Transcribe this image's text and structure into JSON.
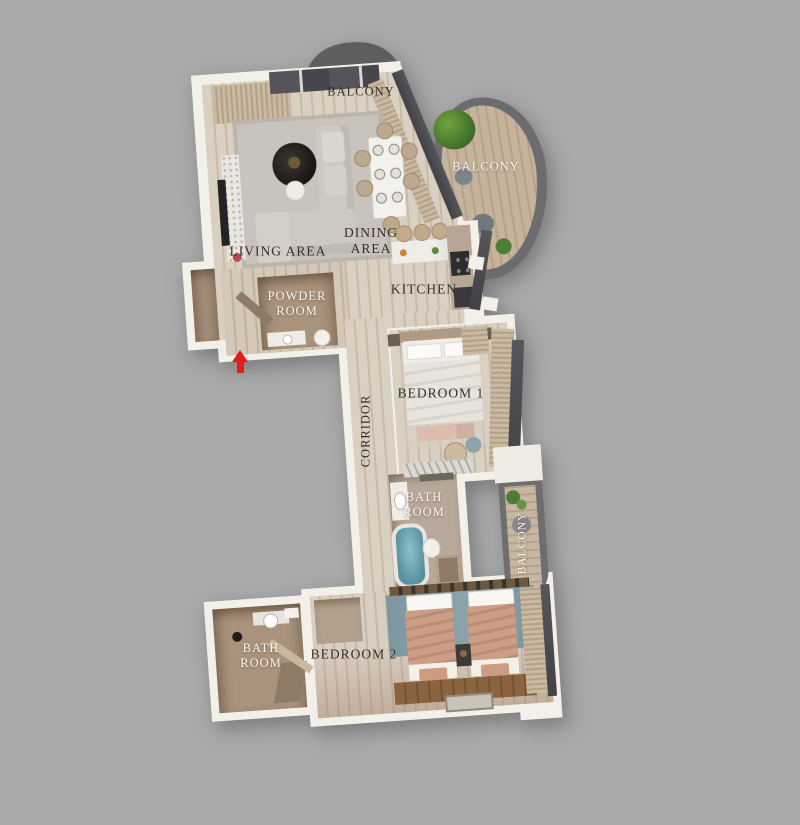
{
  "title": "3D apartment floor plan",
  "background_color": "#a9a9a9",
  "colors": {
    "wall": "#f3f0ea",
    "floor_wood": "#d5c9ba",
    "floor_taupe": "#a9937d",
    "window_glass": "#48484c",
    "curtain": "#c4b29b",
    "balcony_rim": "#6c6c6e",
    "bathtub_teal": "#6fa7b2",
    "bedroom2_carpet": "#7d97a0",
    "bed_blanket_salmon": "#c59880",
    "label_dark": "#342e26",
    "label_light": "#f8f5ef",
    "entrance_arrow": "#e41c19"
  },
  "labels": [
    {
      "id": "balcony-top",
      "text": "BALCONY"
    },
    {
      "id": "balcony-right",
      "text": "BALCONY"
    },
    {
      "id": "living-area",
      "text": "LIVING AREA"
    },
    {
      "id": "dining-area",
      "text": "DINING\nAREA"
    },
    {
      "id": "kitchen",
      "text": "KITCHEN"
    },
    {
      "id": "powder-room",
      "text": "POWDER\nROOM"
    },
    {
      "id": "corridor",
      "text": "CORRIDOR"
    },
    {
      "id": "bedroom-1",
      "text": "BEDROOM 1"
    },
    {
      "id": "bathroom-1",
      "text": "BATH\nROOM"
    },
    {
      "id": "balcony-middle",
      "text": "BALCONY"
    },
    {
      "id": "bedroom-2",
      "text": "BEDROOM 2"
    },
    {
      "id": "bathroom-2",
      "text": "BATH\nROOM"
    }
  ],
  "entrance": {
    "symbol": "arrow-up",
    "color": "#e41c19"
  }
}
